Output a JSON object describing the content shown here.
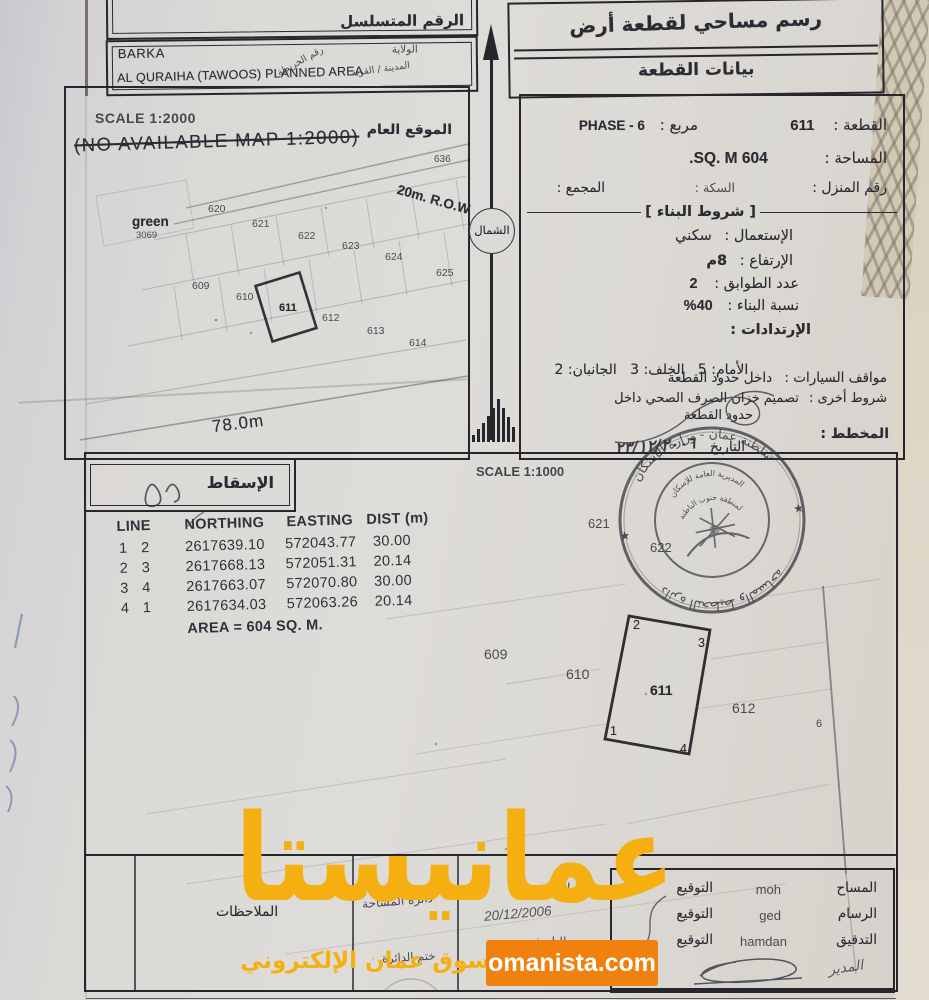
{
  "header": {
    "serial_label": "الرقم المتسلسل",
    "doc_title": "رسم مساحي لقطعة أرض",
    "doc_subtitle": "بيانات القطعة",
    "wilaya_value": "BARKA",
    "area_value": "AL QURAIHA (TAWOOS) PLANNED AREA",
    "wilaya_label": "الولاية",
    "town_label": "المدينة / القرية",
    "map_no_label": "رقم الخريطة"
  },
  "north_label": "الشمال",
  "general_map": {
    "scale": "SCALE 1:2000",
    "no_map_note": "(NO AVAILABLE MAP 1:2000)",
    "location_label": "الموقع العام",
    "row_label": "20m. R.O.W",
    "green_label": "green",
    "green_number": "3069",
    "length_label": "78.0m",
    "plots": [
      "636",
      "620",
      "621",
      "622",
      "623",
      "624",
      "625",
      "609",
      "610",
      "611",
      "612",
      "613",
      "614"
    ]
  },
  "plot_info": {
    "plot_label": "القطعة :",
    "plot_value": "611",
    "block_label": "مربع :",
    "block_value": "PHASE - 6",
    "area_label": "المساحة :",
    "area_value": "604 SQ. M.",
    "house_label": "رقم المنزل :",
    "lane_label": "السكة :",
    "complex_label": "المجمع :"
  },
  "building": {
    "header": "شروط البناء",
    "use_label": "الإستعمال :",
    "use_value": "سكني",
    "height_label": "الإرتفاع :",
    "height_value": "8م",
    "floors_label": "عدد الطوابق :",
    "floors_value": "2",
    "ratio_label": "نسبة البناء :",
    "ratio_value": "40%",
    "setbacks_label": "الإرتدادات :",
    "setbacks_value": "الأمام: 5   الخلف: 3   الجانبان: 2",
    "parking_label": "مواقف السيارات :",
    "parking_value": "داخل حدود القطعة",
    "other_label": "شروط أخرى :",
    "other_value_1": "تصميم خزان الصرف الصحي داخل",
    "other_value_2": "حدود القطعة",
    "planner_label": "المخطط :",
    "date_label": "التاريخ",
    "date_value": "٢٣/١٢/٢٠٠٦"
  },
  "site_plan": {
    "scale": "SCALE 1:1000",
    "projection_label": "الإسقاط",
    "plots": [
      "621",
      "622",
      "609",
      "610",
      "611",
      "612",
      "6"
    ],
    "corners": [
      "2",
      "3",
      "1",
      "4"
    ]
  },
  "coords": {
    "headers": [
      "LINE",
      "NORTHING",
      "EASTING",
      "DIST (m)"
    ],
    "rows": [
      [
        "1",
        "2",
        "2617639.10",
        "572043.77",
        "30.00"
      ],
      [
        "2",
        "3",
        "2617668.13",
        "572051.31",
        "20.14"
      ],
      [
        "3",
        "4",
        "2617663.07",
        "572070.80",
        "30.00"
      ],
      [
        "4",
        "1",
        "2617634.03",
        "572063.26",
        "20.14"
      ]
    ],
    "area_note": "AREA = 604 SQ. M."
  },
  "stamp": {
    "top_arc": "سلطنة عمان - وزارة الإسكان",
    "inner_arc_1": "المديرية العامة للإسكان",
    "inner_arc_2": "لمنطقة جنوب الباطنة",
    "bottom_arc": "دائرة التخطيط والمساحة"
  },
  "footer": {
    "notes_label": "الملاحظات",
    "dept_label": "دائرة المساحة",
    "dept_stamp_label": "ختم الدائرة",
    "date_label": "التاريخ",
    "date_value": "20/12/2006",
    "rows": [
      {
        "role": "المساح",
        "name": "moh",
        "sign_label": "التوقيع"
      },
      {
        "role": "الرسام",
        "name": "ged",
        "sign_label": "التوقيع"
      },
      {
        "role": "التدقيق",
        "name": "hamdan",
        "sign_label": "التوقيع"
      }
    ],
    "director_label": "المدير"
  },
  "watermark": {
    "title": "عمانيستا",
    "subtitle": "سوق عمان الإلكتروني",
    "site": "omanista.com",
    "accent_color": "#F5AF10",
    "box_color": "#F0810F"
  }
}
